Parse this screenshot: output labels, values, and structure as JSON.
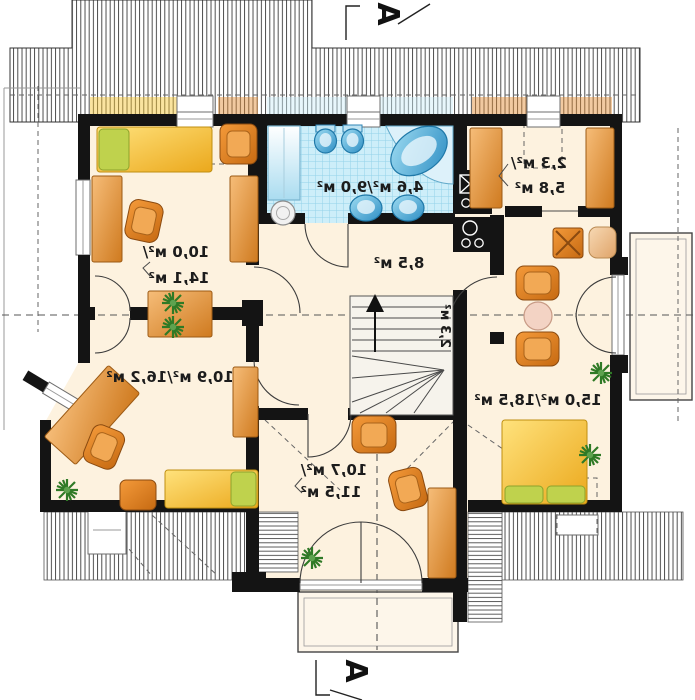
{
  "plan_title": "attic-floor-plan",
  "section_markers": {
    "top": "A",
    "bottom": "A"
  },
  "rooms": {
    "bedroom_top_left": {
      "area_line1": "10,0 м²/",
      "area_line2": "14,1 м²"
    },
    "bathroom": {
      "area": "4,6 м²/9,0 м²"
    },
    "wardrobe": {
      "area_line1": "2,3 м²/",
      "area_line2": "5,8 м²"
    },
    "hall": {
      "area": "8,5 м²"
    },
    "stairs": {
      "area": "2,3 м²"
    },
    "bedroom_bottom_left": {
      "area": "10,9 м²/16,2 м²"
    },
    "bedroom_bottom_center": {
      "area_line1": "10,7 м²/",
      "area_line2": "11,5 м²"
    },
    "living_bedroom_right": {
      "area": "15,0 м²/18,5 м²"
    }
  },
  "colors": {
    "wall": "#141414",
    "floor": "#fdf2df",
    "furniture_orange": "#e2892f",
    "bed_yellow": "#f6c42c",
    "pillow_green": "#bfd24d",
    "tile_blue": "#cdeef9",
    "fixture_blue": "#49a8d8",
    "plant_green": "#2f7a26",
    "label_text": "#1c1c1c"
  }
}
